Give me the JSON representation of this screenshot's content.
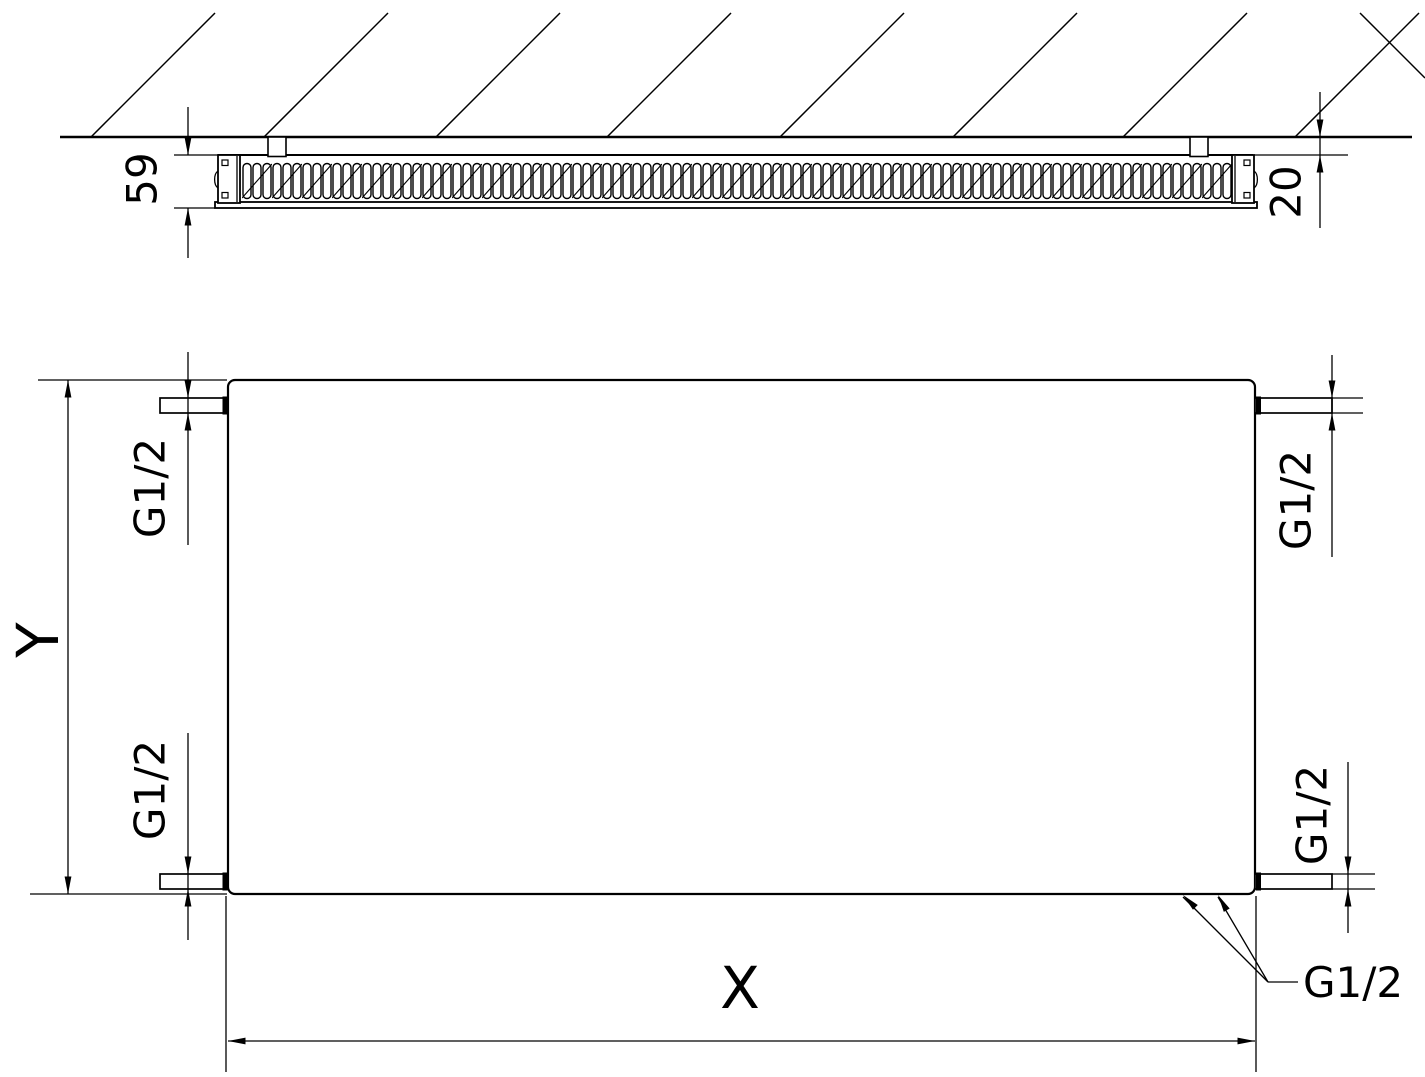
{
  "top_view": {
    "depth": "59",
    "wall_clearance": "20"
  },
  "front_view": {
    "width": "X",
    "height": "Y",
    "connections": {
      "top_left": "G1/2",
      "top_right": "G1/2",
      "bottom_left": "G1/2",
      "bottom_right": "G1/2",
      "bottom_outlets": "G1/2"
    }
  },
  "colors": {
    "line": "#000000",
    "background": "#ffffff"
  }
}
